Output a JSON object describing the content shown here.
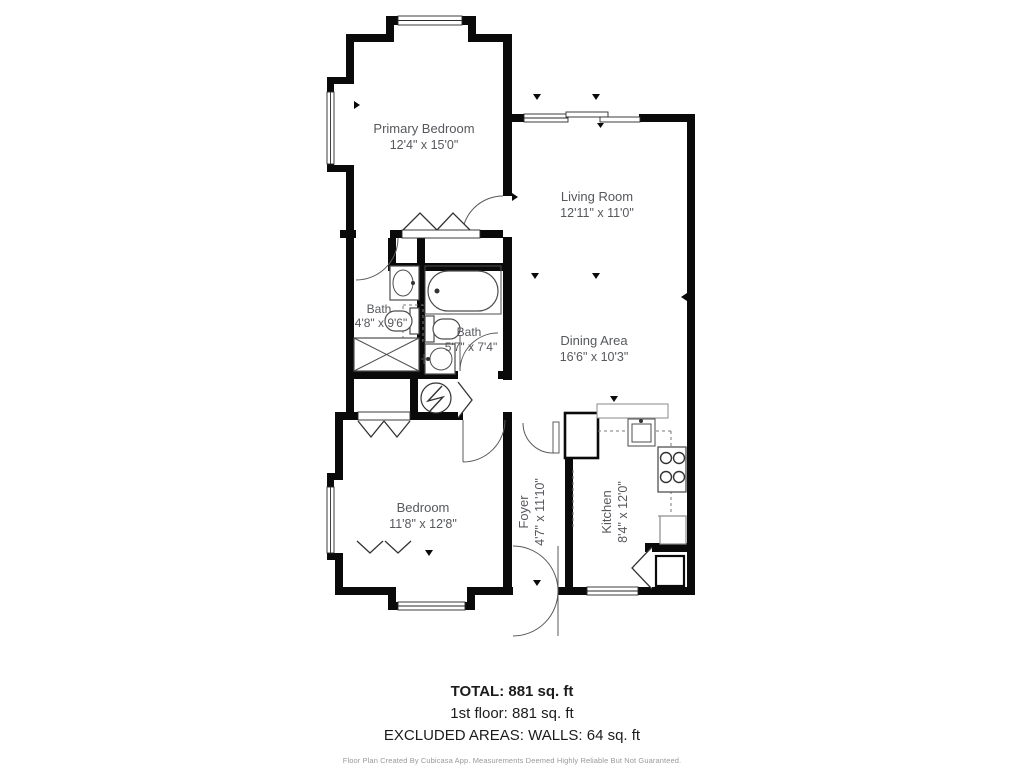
{
  "plan": {
    "rooms": [
      {
        "name": "Primary Bedroom",
        "dims": "12'4\" x 15'0\""
      },
      {
        "name": "Living Room",
        "dims": "12'11\" x 11'0\""
      },
      {
        "name": "Bath",
        "dims": "4'8\" x 9'6\""
      },
      {
        "name": "Bath",
        "dims": "5'7\" x 7'4\""
      },
      {
        "name": "Dining Area",
        "dims": "16'6\" x 10'3\""
      },
      {
        "name": "Bedroom",
        "dims": "11'8\" x 12'8\""
      },
      {
        "name": "Foyer",
        "dims": "4'7\" x 11'10\""
      },
      {
        "name": "Kitchen",
        "dims": "8'4\" x 12'0\""
      }
    ],
    "summary": {
      "total": "TOTAL: 881 sq. ft",
      "floor": "1st floor: 881 sq. ft",
      "excluded": "EXCLUDED AREAS: WALLS: 64 sq. ft"
    },
    "footer": "Floor Plan Created By Cubicasa App. Measurements Deemed Highly Reliable But Not Guaranteed.",
    "colors": {
      "wall": "#0a0a0a",
      "label": "#56585d",
      "fixture": "#4d4d4d"
    }
  }
}
